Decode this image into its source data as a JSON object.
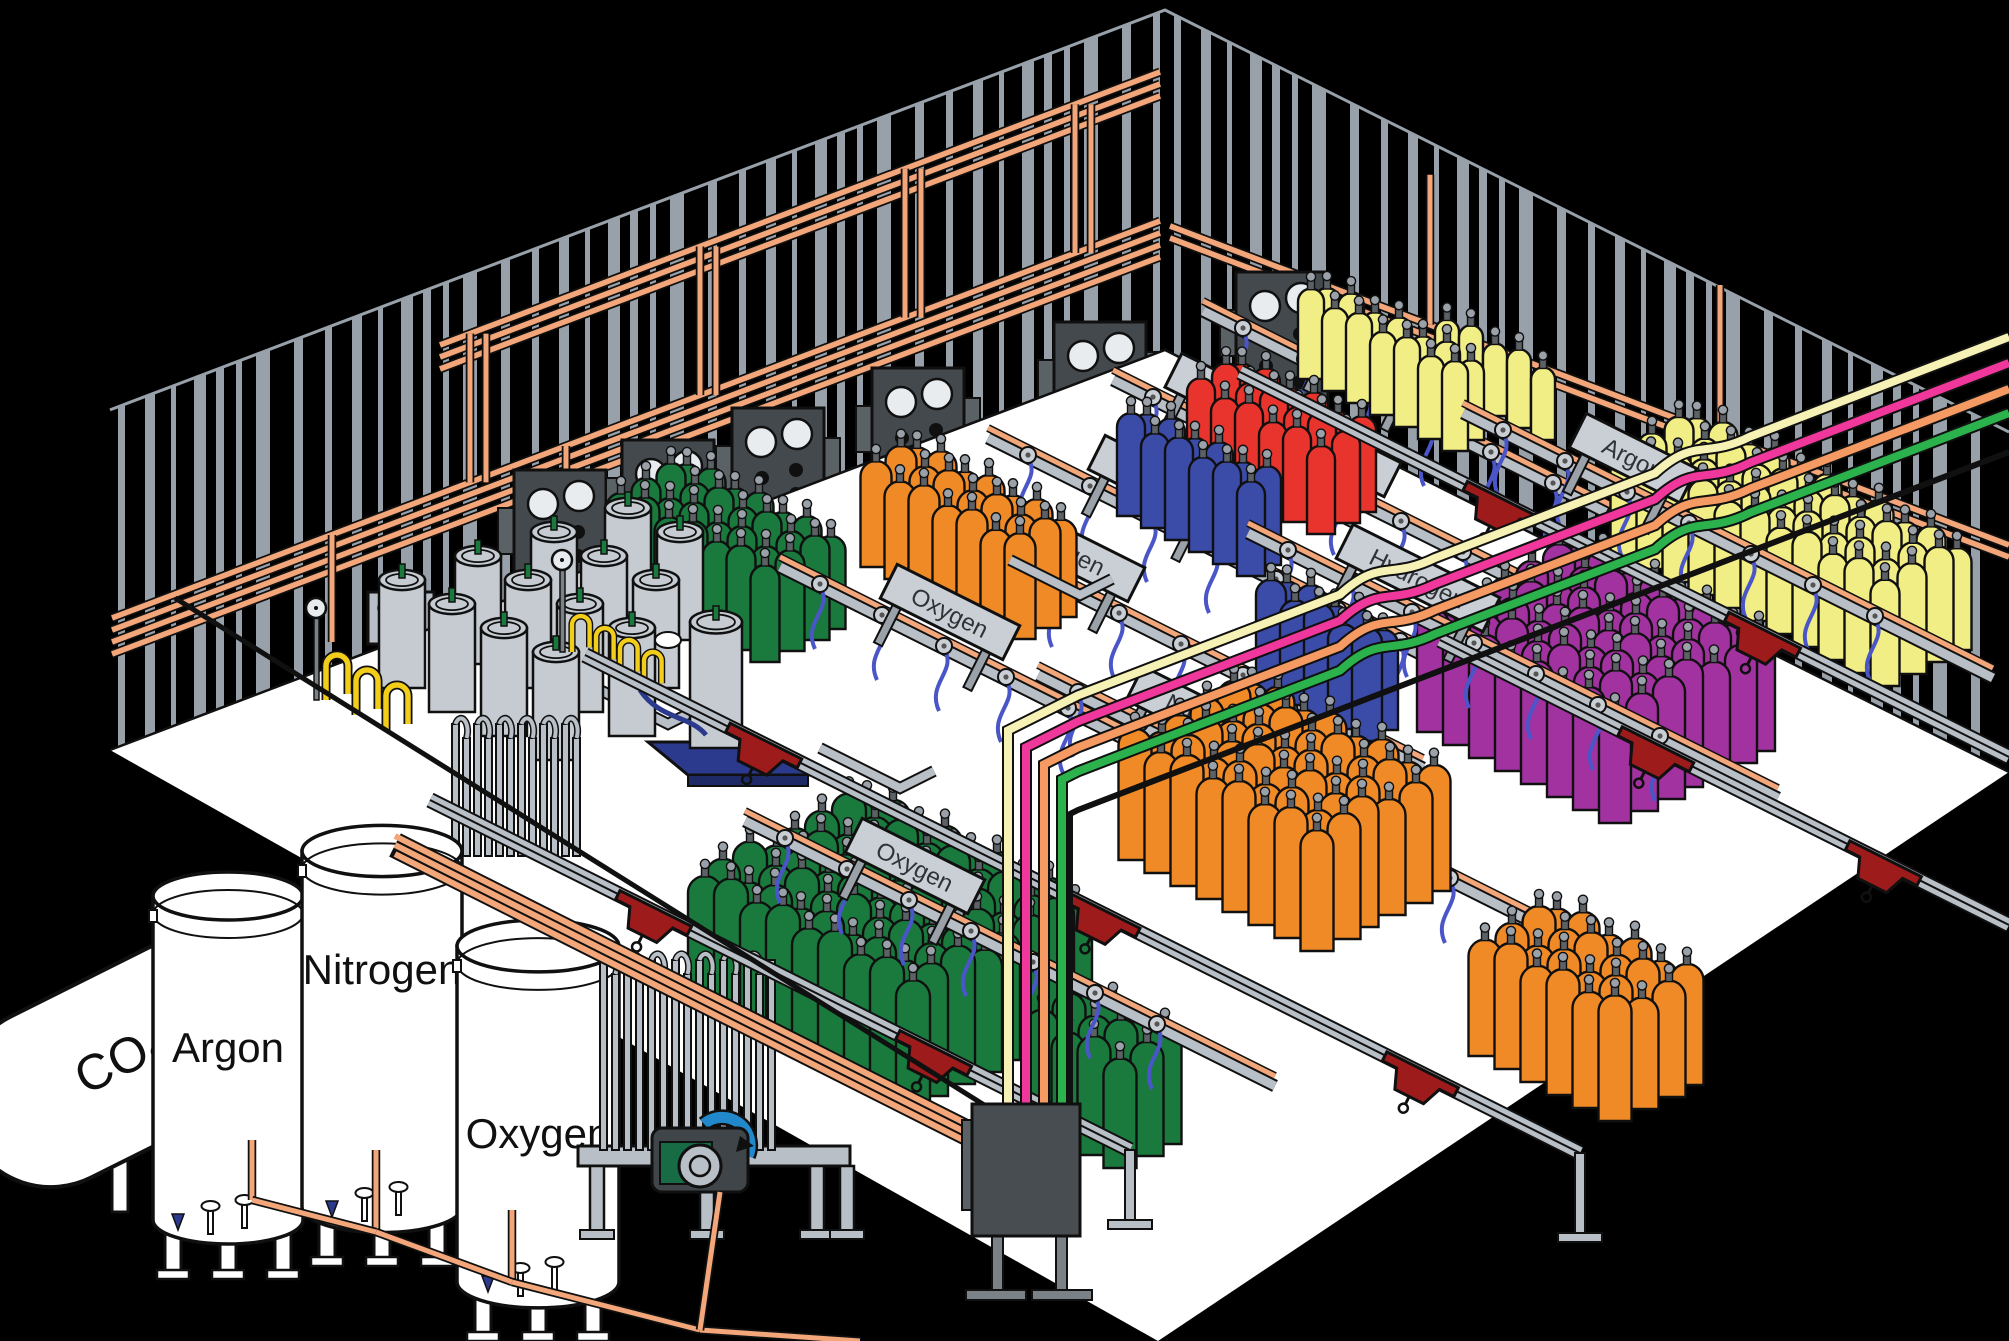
{
  "title": "Gas cylinder filling plant isometric diagram",
  "canvas": {
    "width": 2009,
    "height": 1341
  },
  "palette": {
    "background": "#000000",
    "outline": "#101010",
    "wallStripe": "#98A1A9",
    "floor": "#FFFFFF",
    "railGray": "#B9BFC6",
    "signPlate": "#C9CFD5",
    "signText": "#2F3338",
    "copper": "#F2A679",
    "trolleyRed": "#9E1B1B",
    "hose": "#4A55C8",
    "dewar": "#C6CBD1",
    "pallet": "#2B3A8C",
    "panel": "#43494C",
    "panelTab": "#5B6266",
    "gauge": "#E8ECEF",
    "legGray": "#7A8187",
    "pumpBody": "#3F4549",
    "pumpGreen": "#176B45",
    "pumpBlue": "#2288CC",
    "yellowHose": "#F2CE1B",
    "tankWhite": "#FFFFFF",
    "cylinders": {
      "green": "#1A7A3D",
      "orange": "#F08A26",
      "blue": "#3B4BA8",
      "red": "#E8342C",
      "yellow": "#F2EE86",
      "purple": "#A232A0"
    },
    "serviceLines": {
      "cream": "#F6F1B5",
      "pink": "#F0379B",
      "salmon": "#F59A62",
      "green": "#2BB24C"
    }
  },
  "walls": {
    "apexX": 1165,
    "topY": 10,
    "height": 340,
    "leftSlope": 0.379,
    "rightSlope": 0.5,
    "leftEndX": 110,
    "rightEndX": 2009
  },
  "storage": {
    "co2_tank": {
      "label": "CO2",
      "x": 185,
      "y": 1030
    },
    "vertical_tanks": [
      {
        "label": "Argon",
        "cx": 228,
        "top": 880,
        "w": 150,
        "h": 340,
        "labelY": 1062
      },
      {
        "label": "Nitrogen",
        "cx": 382,
        "top": 835,
        "w": 160,
        "h": 372,
        "labelY": 984
      },
      {
        "label": "Oxygen",
        "cx": 538,
        "top": 930,
        "w": 162,
        "h": 352,
        "labelY": 1148
      }
    ]
  },
  "fill_rows": [
    {
      "label": "Argon",
      "x": 1373,
      "y": 356,
      "clusters": [
        {
          "color": "yellow",
          "x": 1450,
          "y": 392,
          "cols": 5,
          "rows": 1,
          "w": 24,
          "h": 78
        }
      ]
    },
    {
      "label": "Carbon Dioxide",
      "x": 1283,
      "y": 425,
      "clusters": [
        {
          "color": "yellow",
          "x": 1330,
          "y": 368,
          "cols": 7,
          "rows": 2,
          "w": 26,
          "h": 86
        }
      ]
    },
    {
      "label": "Helium",
      "x": 1158,
      "y": 483,
      "clusters": [
        {
          "color": "red",
          "x": 1245,
          "y": 452,
          "cols": 6,
          "rows": 3,
          "w": 28,
          "h": 95
        }
      ]
    },
    {
      "label": "Nitrogen",
      "x": 1063,
      "y": 548,
      "clusters": [
        {
          "color": "blue",
          "x": 1150,
          "y": 505,
          "cols": 6,
          "rows": 2,
          "w": 28,
          "h": 98
        }
      ]
    },
    {
      "label": "Oxygen",
      "x": 950,
      "y": 612,
      "clusters": [
        {
          "color": "orange",
          "x": 920,
          "y": 545,
          "cols": 7,
          "rows": 3,
          "w": 31,
          "h": 105
        },
        {
          "color": "green",
          "x": 690,
          "y": 557,
          "cols": 7,
          "rows": 4,
          "w": 29,
          "h": 100
        }
      ]
    },
    {
      "label": "Argon",
      "x": 1633,
      "y": 458,
      "clusters": [
        {
          "color": "yellow",
          "x": 1700,
          "y": 520,
          "cols": 11,
          "rows": 4,
          "w": 29,
          "h": 110,
          "big": true
        }
      ]
    },
    {
      "label": "Hydrogen",
      "x": 1418,
      "y": 578,
      "clusters": [
        {
          "color": "purple",
          "x": 1580,
          "y": 660,
          "cols": 8,
          "rows": 7,
          "w": 32,
          "h": 122,
          "big": true
        }
      ]
    },
    {
      "label": "Nitrogen",
      "x": 1208,
      "y": 720,
      "clusters": [
        {
          "color": "blue",
          "x": 1290,
          "y": 682,
          "cols": 5,
          "rows": 2,
          "w": 30,
          "h": 108
        }
      ]
    },
    {
      "label": "Oxygen",
      "x": 915,
      "y": 866,
      "clusters": [
        {
          "color": "orange",
          "x": 1255,
          "y": 800,
          "cols": 8,
          "rows": 6,
          "w": 33,
          "h": 125,
          "big": true
        },
        {
          "color": "orange",
          "x": 1560,
          "y": 1020,
          "cols": 6,
          "rows": 4,
          "w": 33,
          "h": 120,
          "big": true
        },
        {
          "color": "green",
          "x": 870,
          "y": 920,
          "cols": 9,
          "rows": 8,
          "w": 34,
          "h": 132,
          "big": true
        },
        {
          "color": "green",
          "x": 1090,
          "y": 1105,
          "cols": 4,
          "rows": 3,
          "w": 33,
          "h": 118,
          "big": true
        }
      ]
    }
  ],
  "wall_panels": [
    [
      560,
      470
    ],
    [
      668,
      440
    ],
    [
      778,
      408
    ],
    [
      918,
      368
    ],
    [
      1100,
      322
    ],
    [
      1282,
      272
    ]
  ],
  "control_box": {
    "x": 368,
    "y": 592,
    "buttons": 4
  },
  "crane_rails": [
    {
      "x1": 430,
      "y1": 800,
      "x2": 1130,
      "y2": 1150,
      "trolleys": [
        0.32,
        0.72
      ],
      "post": 70
    },
    {
      "x1": 585,
      "y1": 655,
      "x2": 1580,
      "y2": 1153,
      "trolleys": [
        0.18,
        0.52,
        0.84
      ],
      "post": 80
    },
    {
      "x1": 1240,
      "y1": 372,
      "x2": 2009,
      "y2": 757,
      "trolleys": [
        0.34,
        0.68
      ]
    },
    {
      "x1": 1440,
      "y1": 640,
      "x2": 2009,
      "y2": 925,
      "trolleys": [
        0.38,
        0.78
      ]
    }
  ],
  "service_lines": [
    {
      "color": "cream",
      "yRight": 337,
      "xDrop": 1008
    },
    {
      "color": "pink",
      "yRight": 363,
      "xDrop": 1026
    },
    {
      "color": "salmon",
      "yRight": 389,
      "xDrop": 1044
    },
    {
      "color": "green",
      "yRight": 413,
      "xDrop": 1062
    }
  ],
  "dewars": [
    [
      402,
      688
    ],
    [
      478,
      664
    ],
    [
      554,
      640
    ],
    [
      628,
      616
    ],
    [
      452,
      712
    ],
    [
      528,
      688
    ],
    [
      604,
      664
    ],
    [
      680,
      640
    ],
    [
      504,
      736
    ],
    [
      580,
      712
    ],
    [
      656,
      688
    ],
    [
      556,
      760
    ],
    [
      632,
      736
    ]
  ],
  "pallet_dewar": {
    "x": 716,
    "y": 748
  },
  "vaporizers": [
    {
      "x": 452,
      "yb": 856,
      "n": 12,
      "gap": 11,
      "h": 132
    },
    {
      "x": 600,
      "yb": 1150,
      "n": 15,
      "gap": 12,
      "h": 190,
      "platform": true
    }
  ],
  "hose_stations": [
    {
      "x": 326,
      "y": 700,
      "n": 3,
      "s": 1.0
    },
    {
      "x": 572,
      "y": 652,
      "n": 4,
      "s": 0.8
    }
  ],
  "floor_stands": [
    [
      596,
      688,
      668,
      724,
      700,
      708
    ],
    [
      820,
      748,
      900,
      788,
      934,
      771
    ],
    [
      1010,
      560,
      1080,
      595,
      1112,
      579
    ]
  ],
  "ground_pipes": [
    [
      252,
      1140,
      252,
      1200
    ],
    [
      376,
      1150,
      376,
      1232
    ],
    [
      512,
      1210,
      512,
      1282
    ],
    [
      252,
      1200,
      376,
      1232
    ],
    [
      376,
      1232,
      512,
      1282
    ],
    [
      512,
      1282,
      700,
      1330
    ],
    [
      700,
      1330,
      860,
      1341
    ],
    [
      720,
      1192,
      700,
      1330
    ]
  ],
  "corner_panel": {
    "x": 972,
    "y": 1104,
    "w": 108,
    "h": 132
  }
}
